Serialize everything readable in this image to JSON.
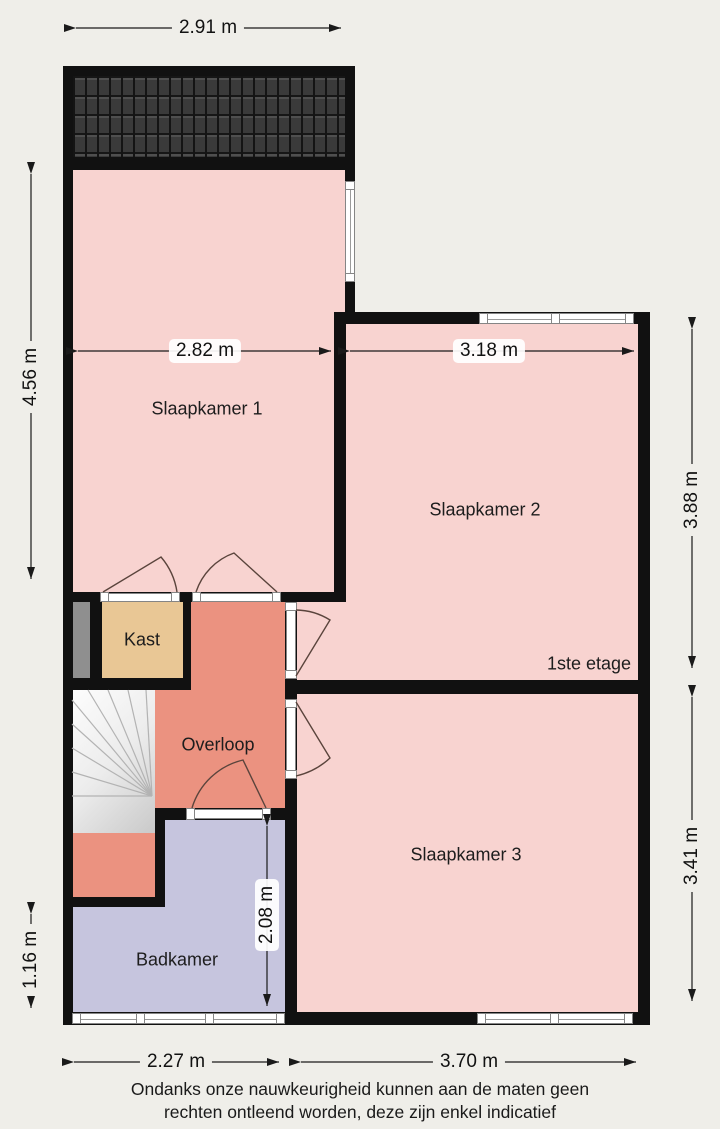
{
  "plan": {
    "floor_label": "1ste etage",
    "rooms": [
      {
        "id": "slaapkamer1",
        "label": "Slaapkamer 1"
      },
      {
        "id": "slaapkamer2",
        "label": "Slaapkamer 2"
      },
      {
        "id": "slaapkamer3",
        "label": "Slaapkamer 3"
      },
      {
        "id": "kast",
        "label": "Kast"
      },
      {
        "id": "overloop",
        "label": "Overloop"
      },
      {
        "id": "badkamer",
        "label": "Badkamer"
      }
    ],
    "dimensions": {
      "top_width": "2.91 m",
      "left_height_upper": "4.56 m",
      "left_height_lower": "1.16 m",
      "right_height_upper": "3.88 m",
      "right_height_lower": "3.41 m",
      "slaapkamer1_width": "2.82 m",
      "slaapkamer2_width": "3.18 m",
      "badkamer_height": "2.08 m",
      "bottom_width_left": "2.27 m",
      "bottom_width_right": "3.70 m"
    },
    "disclaimer_line1": "Ondanks onze nauwkeurigheid kunnen aan de maten geen",
    "disclaimer_line2": "rechten ontleend worden, deze zijn enkel indicatief",
    "colors": {
      "background": "#efeee9",
      "wall": "#111111",
      "room_pink": "#f8d3d0",
      "overloop_salmon": "#eb9280",
      "kast_tan": "#e9c795",
      "badkamer_lavender": "#c6c5de",
      "duct_gray": "#8f8f8f",
      "stairs_light": "#ececec",
      "door_arc": "#5a443c",
      "roof_tiles": "#333333"
    }
  }
}
